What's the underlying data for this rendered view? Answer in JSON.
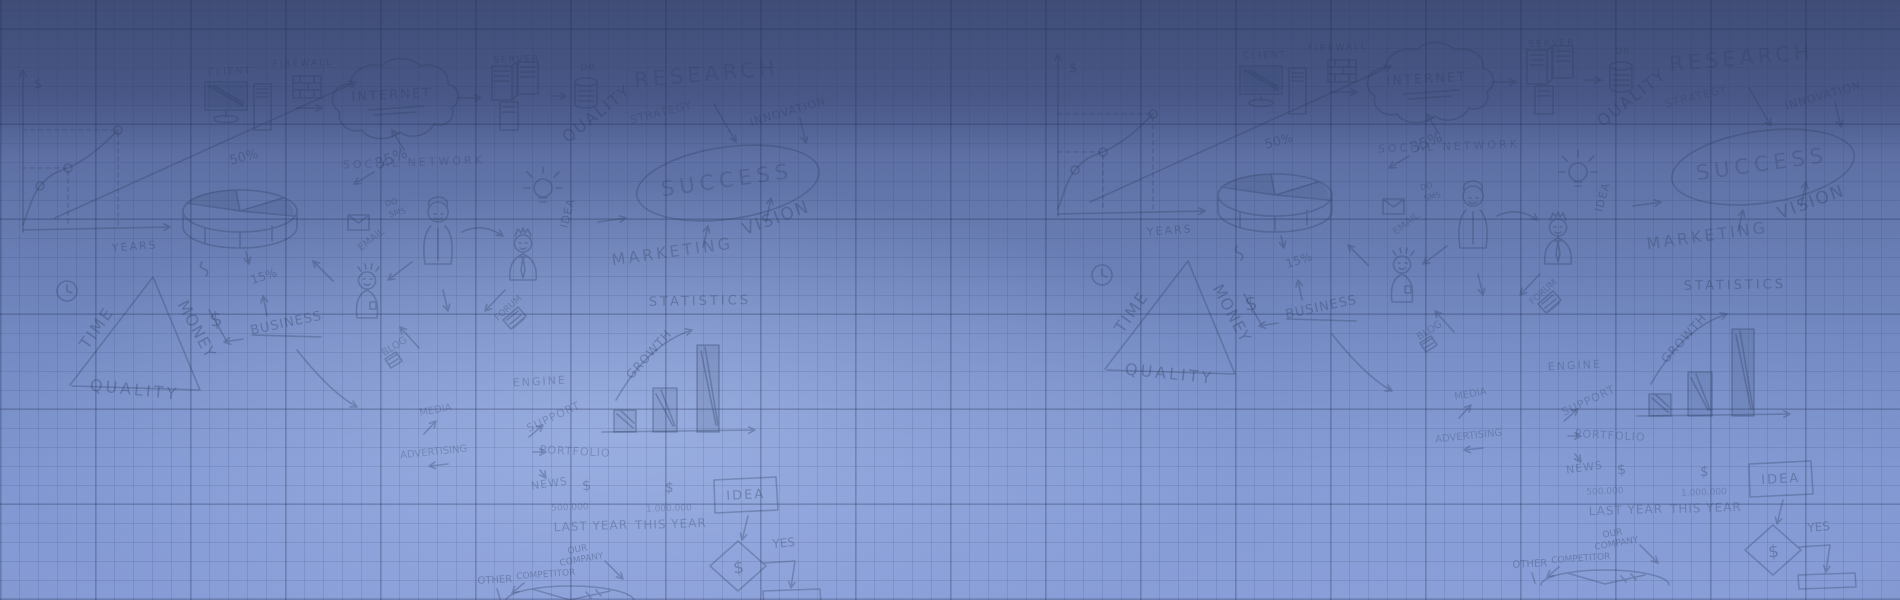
{
  "banner": {
    "description": "Hand-drawn business doodle banner on blue graph-paper gradient; doodle set repeats twice horizontally",
    "palette": {
      "bg_top": "#4e5d8a",
      "bg_bottom": "#879cd6",
      "bg_bright_spot": "#97abde",
      "bg_edge_vignette": "#5e6fa2",
      "grid_line": "#25335c",
      "ink": "#2b3a5e"
    },
    "motifs": [
      "line-chart-doodle",
      "pie-chart-doodle",
      "client-monitor-doodle",
      "pc-tower-doodle",
      "firewall-doodle",
      "internet-cloud-doodle",
      "server-racks-doodle",
      "db-cylinder-doodle",
      "lightbulb-doodle",
      "success-ellipse-doodle",
      "email-envelope-doodle",
      "woman-figure-doodle",
      "crowned-man-figure-doodle",
      "boy-figure-doodle",
      "clock-doodle",
      "triangle-doodle",
      "forum-tag-doodle",
      "blog-tag-doodle",
      "statistics-bars-doodle",
      "idea-box-doodle",
      "decision-diamond-doodle",
      "result-box-doodle",
      "company-pie-doodle",
      "arrow-doodles"
    ]
  },
  "doodle_words": [
    {
      "t": "$",
      "x": 38,
      "y": 88,
      "r": 0,
      "s": 13
    },
    {
      "t": "YEARS",
      "x": 135,
      "y": 250,
      "r": -4,
      "s": 11,
      "ls": 2
    },
    {
      "t": "35%",
      "x": 393,
      "y": 163,
      "r": -22,
      "s": 15
    },
    {
      "t": "50%",
      "x": 245,
      "y": 161,
      "r": -15,
      "s": 13
    },
    {
      "t": "CLIENT",
      "x": 230,
      "y": 74,
      "r": -2,
      "s": 9,
      "ls": 2
    },
    {
      "t": "FIREWALL",
      "x": 303,
      "y": 66,
      "r": -2,
      "s": 9,
      "ls": 2
    },
    {
      "t": "INTERNET",
      "x": 392,
      "y": 99,
      "r": -3,
      "s": 13,
      "ls": 2
    },
    {
      "t": "SERVER",
      "x": 517,
      "y": 62,
      "r": -2,
      "s": 9,
      "ls": 2
    },
    {
      "t": "DB",
      "x": 588,
      "y": 70,
      "r": 0,
      "s": 9,
      "ls": 1
    },
    {
      "t": "QUALITY",
      "x": 600,
      "y": 118,
      "r": -38,
      "s": 16,
      "ls": 2
    },
    {
      "t": "SOCIAL NETWORK",
      "x": 414,
      "y": 166,
      "r": -2,
      "s": 11,
      "ls": 3,
      "o": 0.28
    },
    {
      "t": "RESEARCH",
      "x": 707,
      "y": 81,
      "r": -5,
      "s": 21,
      "ls": 4,
      "o": 0.25
    },
    {
      "t": "INNOVATION",
      "x": 789,
      "y": 115,
      "r": -16,
      "s": 11,
      "ls": 1
    },
    {
      "t": "STRATEGY",
      "x": 662,
      "y": 116,
      "r": -14,
      "s": 11,
      "ls": 1,
      "o": 0.27
    },
    {
      "t": "SUCCESS",
      "x": 728,
      "y": 187,
      "r": -8,
      "s": 21,
      "ls": 5,
      "o": 0.26
    },
    {
      "t": "VISION",
      "x": 778,
      "y": 223,
      "r": -20,
      "s": 17,
      "ls": 2
    },
    {
      "t": "MARKETING",
      "x": 673,
      "y": 257,
      "r": -8,
      "s": 16,
      "ls": 3,
      "o": 0.3
    },
    {
      "t": "IDEA",
      "x": 571,
      "y": 214,
      "r": -75,
      "s": 11,
      "ls": 1
    },
    {
      "t": "DO",
      "x": 392,
      "y": 205,
      "r": -15,
      "s": 8
    },
    {
      "t": "SMS",
      "x": 398,
      "y": 215,
      "r": -15,
      "s": 8
    },
    {
      "t": "EMAIL",
      "x": 373,
      "y": 242,
      "r": -38,
      "s": 10,
      "o": 0.28
    },
    {
      "t": "TIME",
      "x": 101,
      "y": 331,
      "r": -55,
      "s": 16,
      "ls": 2
    },
    {
      "t": "MONEY",
      "x": 192,
      "y": 332,
      "r": 62,
      "s": 16,
      "ls": 1
    },
    {
      "t": "QUALITY",
      "x": 134,
      "y": 395,
      "r": 6,
      "s": 16,
      "ls": 3
    },
    {
      "t": "BUSINESS",
      "x": 287,
      "y": 327,
      "r": -12,
      "s": 13,
      "ls": 1
    },
    {
      "t": "15%",
      "x": 265,
      "y": 280,
      "r": -18,
      "s": 12
    },
    {
      "t": "BLOG",
      "x": 396,
      "y": 349,
      "r": -32,
      "s": 10,
      "o": 0.28
    },
    {
      "t": "MEDIA",
      "x": 436,
      "y": 413,
      "r": -10,
      "s": 10,
      "o": 0.28
    },
    {
      "t": "ADVERTISING",
      "x": 434,
      "y": 455,
      "r": -6,
      "s": 10,
      "o": 0.28
    },
    {
      "t": "FORUM",
      "x": 510,
      "y": 310,
      "r": -42,
      "s": 9,
      "o": 0.3
    },
    {
      "t": "ENGINE",
      "x": 540,
      "y": 385,
      "r": -3,
      "s": 11,
      "ls": 2,
      "o": 0.28
    },
    {
      "t": "SUPPORT",
      "x": 555,
      "y": 420,
      "r": -25,
      "s": 11,
      "ls": 1,
      "o": 0.28
    },
    {
      "t": "PORTFOLIO",
      "x": 575,
      "y": 455,
      "r": 3,
      "s": 11,
      "ls": 1,
      "o": 0.28
    },
    {
      "t": "NEWS",
      "x": 550,
      "y": 487,
      "r": -8,
      "s": 11,
      "ls": 1,
      "o": 0.3
    },
    {
      "t": "$",
      "x": 587,
      "y": 490,
      "r": -5,
      "s": 14
    },
    {
      "t": "500.000",
      "x": 570,
      "y": 510,
      "r": -2,
      "s": 9,
      "o": 0.26
    },
    {
      "t": "LAST YEAR",
      "x": 591,
      "y": 530,
      "r": -2,
      "s": 12,
      "ls": 1,
      "o": 0.3
    },
    {
      "t": "$",
      "x": 669,
      "y": 492,
      "r": 5,
      "s": 14
    },
    {
      "t": "1.000.000",
      "x": 669,
      "y": 511,
      "r": -2,
      "s": 9,
      "o": 0.26
    },
    {
      "t": "THIS YEAR",
      "x": 671,
      "y": 528,
      "r": -2,
      "s": 12,
      "ls": 1,
      "o": 0.3
    },
    {
      "t": "OUR",
      "x": 578,
      "y": 552,
      "r": -10,
      "s": 9
    },
    {
      "t": "COMPANY",
      "x": 582,
      "y": 562,
      "r": -10,
      "s": 9
    },
    {
      "t": "COMPETITOR",
      "x": 546,
      "y": 577,
      "r": -4,
      "s": 9
    },
    {
      "t": "OTHER",
      "x": 495,
      "y": 583,
      "r": -3,
      "s": 10
    },
    {
      "t": "STATISTICS",
      "x": 700,
      "y": 305,
      "r": -1,
      "s": 13,
      "ls": 3
    },
    {
      "t": "GROWTH",
      "x": 652,
      "y": 357,
      "r": -48,
      "s": 12,
      "ls": 1
    },
    {
      "t": "IDEA",
      "x": 746,
      "y": 499,
      "r": -3,
      "s": 13,
      "ls": 2
    },
    {
      "t": "YES",
      "x": 784,
      "y": 547,
      "r": -5,
      "s": 12
    },
    {
      "t": "$",
      "x": 739,
      "y": 573,
      "r": -5,
      "s": 17
    },
    {
      "t": "$",
      "x": 217,
      "y": 326,
      "r": -8,
      "s": 20
    }
  ]
}
